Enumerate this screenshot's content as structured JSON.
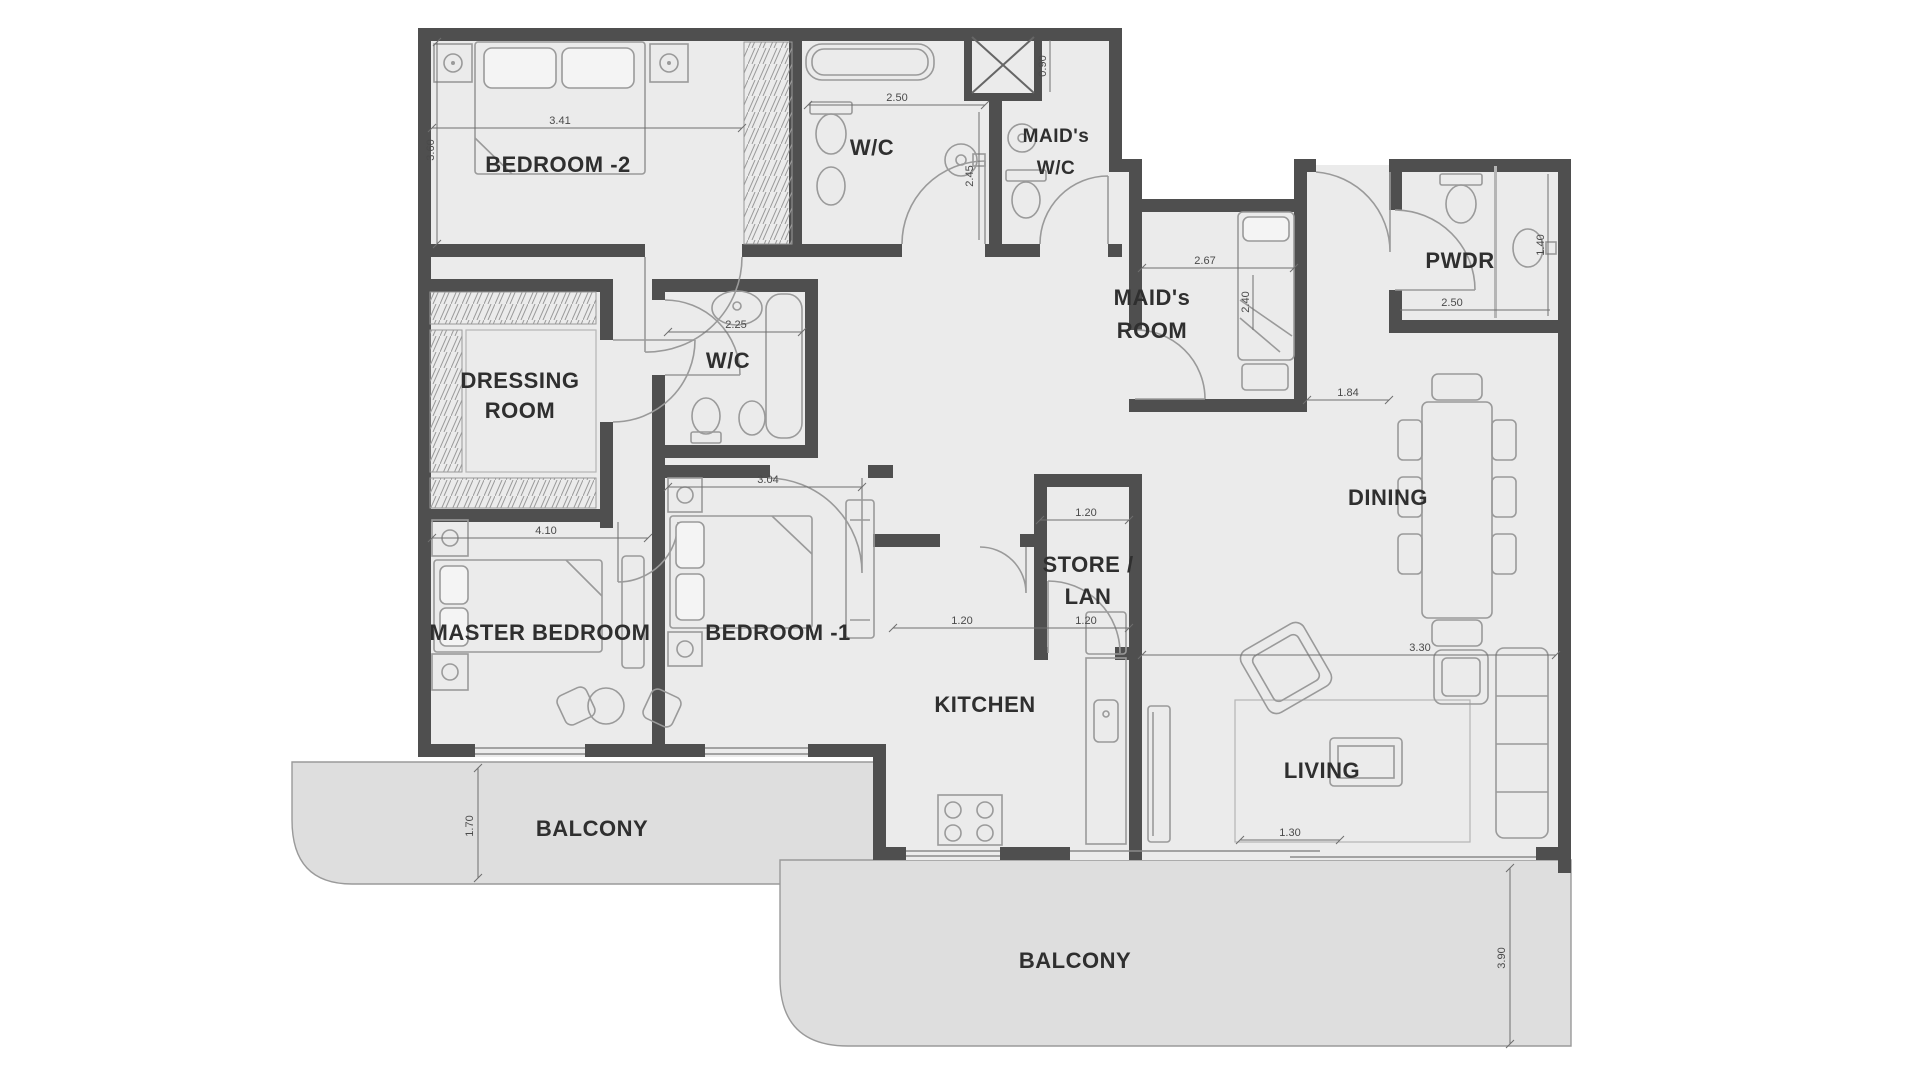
{
  "labels": [
    {
      "text": "BEDROOM -2"
    },
    {
      "text": "W/C"
    },
    {
      "text": "MAID's"
    },
    {
      "text": "W/C"
    },
    {
      "text": "MAID's"
    },
    {
      "text": "ROOM"
    },
    {
      "text": "PWDR"
    },
    {
      "text": "DRESSING"
    },
    {
      "text": "ROOM"
    },
    {
      "text": "W/C"
    },
    {
      "text": "DINING"
    },
    {
      "text": "STORE /"
    },
    {
      "text": "LAN"
    },
    {
      "text": "MASTER BEDROOM"
    },
    {
      "text": "BEDROOM -1"
    },
    {
      "text": "KITCHEN"
    },
    {
      "text": "LIVING"
    },
    {
      "text": "BALCONY"
    },
    {
      "text": "BALCONY"
    }
  ],
  "dims": [
    {
      "v": "3.41"
    },
    {
      "v": "3.60"
    },
    {
      "v": "2.50"
    },
    {
      "v": "2.45"
    },
    {
      "v": "0.90"
    },
    {
      "v": "2.67"
    },
    {
      "v": "2.40"
    },
    {
      "v": "1.84"
    },
    {
      "v": "1.40"
    },
    {
      "v": "2.50"
    },
    {
      "v": "2.25"
    },
    {
      "v": "4.10"
    },
    {
      "v": "3.04"
    },
    {
      "v": "1.20"
    },
    {
      "v": "1.20"
    },
    {
      "v": "1.20"
    },
    {
      "v": "3.30"
    },
    {
      "v": "1.30"
    },
    {
      "v": "1.70"
    },
    {
      "v": "3.90"
    }
  ],
  "colors": {
    "wall": "#4f4f4f",
    "floor": "#ebebeb",
    "balcony": "#dedede",
    "furniture": "#9a9a9a"
  }
}
